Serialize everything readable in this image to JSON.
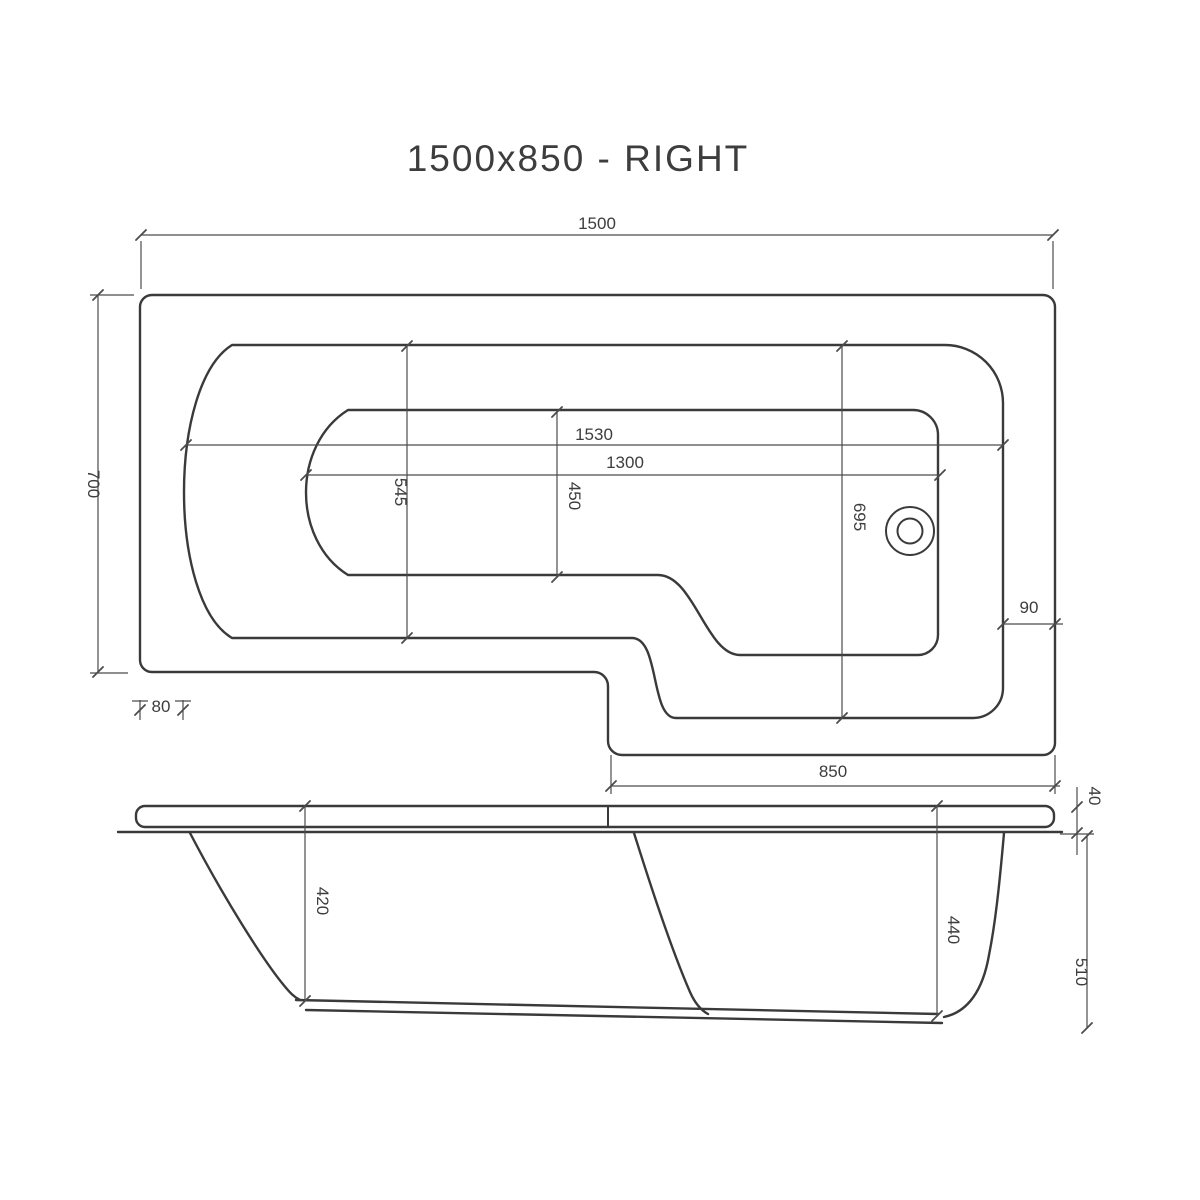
{
  "title": "1500x850 - RIGHT",
  "colors": {
    "background": "#ffffff",
    "line": "#3a3a3a",
    "dimension": "#4c4c4c",
    "text": "#3d3d3d"
  },
  "plan_view": {
    "dim_overall_length": "1500",
    "dim_overall_width": "700",
    "dim_left_rim": "80",
    "dim_inner_rim_length": "1530",
    "dim_basin_length": "1300",
    "dim_bath_width": "545",
    "dim_basin_width": "450",
    "dim_shower_width": "695",
    "dim_right_rim": "90",
    "dim_shower_section_length": "850"
  },
  "side_view": {
    "dim_bath_depth": "420",
    "dim_shower_end_depth": "440",
    "dim_overall_height": "510",
    "dim_rim_thickness": "40"
  }
}
